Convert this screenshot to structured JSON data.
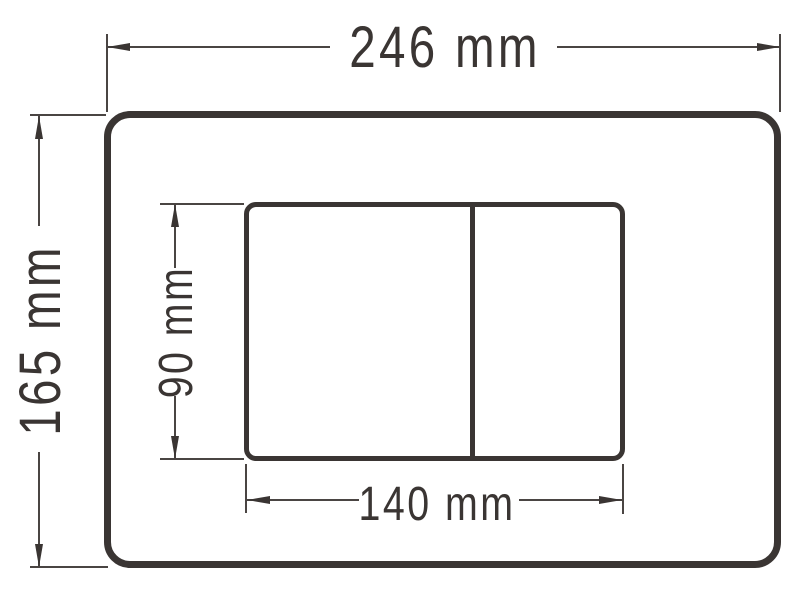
{
  "drawing": {
    "kind": "technical-dimension-drawing",
    "labels": {
      "overall_width": "246 mm",
      "overall_height": "165 mm",
      "buttons_width": "140 mm",
      "buttons_height": "90 mm"
    },
    "colors": {
      "line": "#3a3533",
      "thin_line": "#4a4543",
      "background": "#ffffff"
    }
  }
}
